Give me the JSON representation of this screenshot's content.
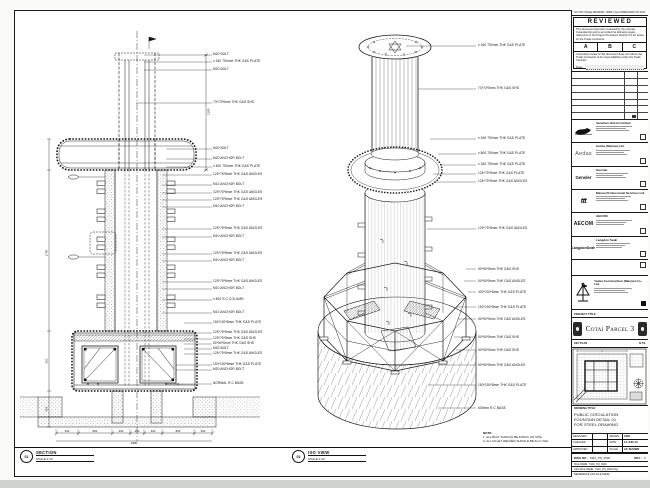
{
  "top_note": "DO NOT SCALE DRAWING. VERIFY ALL DIMENSIONS ON SITE.",
  "reviewed": {
    "title": "REVIEWED",
    "body": "This document has been reviewed by the relevant Consultant(s) and is accorded the following status referred to in the Project Procedure Section 5.4 for action by the Trade Contractor.",
    "a": "A",
    "b": "B",
    "c": "C",
    "footer": "Consultant review of this document does not relieve the Trade Contractor of its responsibilities under the Trade Contract.",
    "date_label": "Date :"
  },
  "consultants": [
    {
      "logo": "Venetian",
      "name": "Venetian Orient Limited"
    },
    {
      "logo": "Aedas",
      "name": "Aedas (Macau) Ltd."
    },
    {
      "logo": "Gensler",
      "name": "Gensler"
    },
    {
      "logo": "ttt",
      "name": "Macau Professional Services Ltd."
    },
    {
      "logo": "AECOM",
      "name": "AECOM"
    },
    {
      "logo": "LangdonSeah",
      "name": "Langdon Seah"
    }
  ],
  "contractor": {
    "name": "Yadea Construction (Macau) Co., Ltd."
  },
  "project": {
    "label": "PROJECT TITLE",
    "name": "Cotai Parcel 3"
  },
  "key_plan": {
    "label": "KEY PLAN",
    "right": "N.T.S."
  },
  "drawing": {
    "label": "DRAWING TITLE:",
    "line1": "PUBLIC CIRCULATION",
    "line2": "FOUNTAIN DETAIL 01",
    "line3": "FOR STEEL DRAWING"
  },
  "fields": {
    "designed_label": "DESIGNED",
    "designed": "",
    "drawn_label": "DRAWN",
    "drawn": "LWO",
    "checked_label": "CHECKED",
    "checked": "-",
    "date_label": "DATE",
    "date": "14-JUN-13",
    "approved_label": "APPROVED",
    "approved": "-",
    "scale_label": "SCALE",
    "scale": "AS SHOWN"
  },
  "dwg": {
    "no_label": "DWG NO :",
    "no": "5110_PQ_0000",
    "rev_label": "REV :",
    "rev": "C",
    "file_label": "FILE NAME :",
    "file": "5110_PQ_0000",
    "cad_label": "CAD FILE NAME :",
    "cad": "5110_PQ_0000.dwg",
    "ref_label": "REFERENCE CAD FILE NAME :"
  },
  "section_view": {
    "callout": "01",
    "title": "SECTION",
    "scale": "SCALE 1:10"
  },
  "iso_view": {
    "callout": "02",
    "title": "ISO VIEW",
    "scale": "SCALE 1:20"
  },
  "notes": {
    "n0": "NOTE:",
    "n1": "1. ALL BOLT SHOULD BE FIXING ON SITE.",
    "n2": "2. ALL FILLET WELDED SHOULD BE 6mm THK."
  },
  "sl": [
    "M20 BOLT",
    "x 340 750mm THK G&S PLATE",
    "M20 BOLT",
    "73*73*5mm THK G&S SHS",
    "M20 BOLT",
    "M20 ANCHOR BOLT",
    "x 500 750mm THK G&S PLATE",
    "125*75*8mm THK G&S ANGLES",
    "M10 ANCHOR BOLT",
    "125*75*8mm THK G&S ANGLES",
    "125*75*8mm THK G&S ANGLES",
    "M10 ANCHOR BOLT",
    "125*75*8mm THK G&S ANGLES",
    "M10 ANCHOR BOLT",
    "125*75*8mm THK G&S ANGLES",
    "M10 ANCHOR BOLT",
    "125*75*8mm THK G&S ANGLES",
    "M10 ANCHOR BOLT",
    "x 800 R.C COLUMN",
    "M10 ANCHOR BOLT",
    "150*150*8mm THK G&S PLATE",
    "125*75*8mm THK G&S ANGLES",
    "125*75*8mm THK G&S SHS",
    "50*50*5mm THK G&S SHS",
    "M20 BOLT",
    "125*75*8mm THK G&S ANGLES",
    "150*150*8mm THK G&S PLATE",
    "M20 ANCHOR BOLT",
    "NORMAL R.C BASE"
  ],
  "il": [
    "x 340 750mm THK G&S PLATE",
    "73*73*5mm THK G&S SHS",
    "x 340 750mm THK G&S PLATE",
    "x 800 750mm THK G&S PLATE",
    "x 340 750mm THK G&S PLATE",
    "125*75*8mm THK G&S PLATE",
    "125*75*8mm THK G&S ANGLES",
    "125*75*8mm THK G&S ANGLES",
    "50*50*5mm THK G&S SHS",
    "50*50*5mm THK G&S ANGLES",
    "400*200*8mm THK G&S PLATE",
    "150*150*8mm THK G&S PLATE",
    "50*50*5mm THK G&S ANGLES",
    "50*50*5mm THK G&S SHS",
    "50*50*5mm THK G&S SHS",
    "50*50*5mm THK G&S ANGLES",
    "150*150*8mm THK G&S PLATE",
    "600mm R.C BASE"
  ],
  "dims": {
    "b0": "300",
    "b1": "860",
    "b2": "300",
    "b3": "450",
    "b4": "300",
    "b5": "860",
    "b6": "300",
    "total": "2980",
    "l0": "1745",
    "l1": "600",
    "l2": "400",
    "r0": "1100"
  }
}
